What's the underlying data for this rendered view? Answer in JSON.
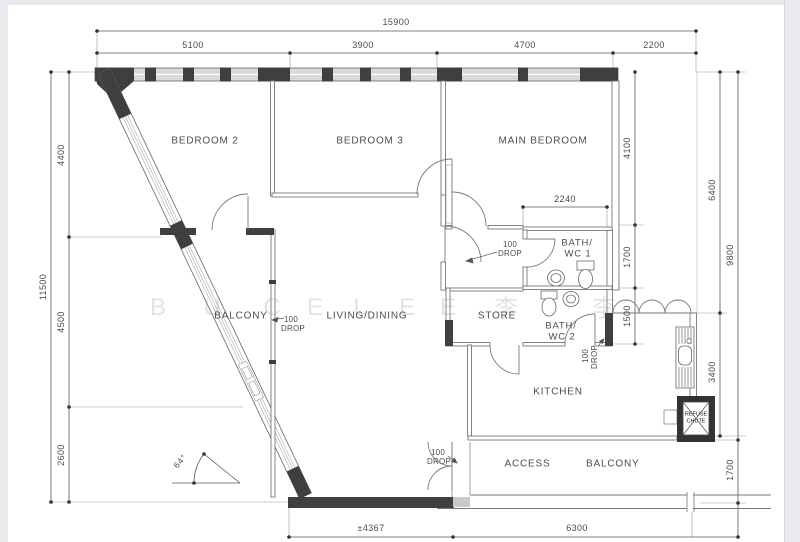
{
  "rooms": {
    "bedroom2": "BEDROOM 2",
    "bedroom3": "BEDROOM 3",
    "main_bedroom": "MAIN BEDROOM",
    "balcony": "BALCONY",
    "living_dining": "LIVING/DINING",
    "store": "STORE",
    "bath1_line1": "BATH/",
    "bath1_line2": "WC 1",
    "bath2_line1": "BATH/",
    "bath2_line2": "WC 2",
    "kitchen": "KITCHEN",
    "access_balcony": "ACCESS BALCONY",
    "refuse_line1": "REFUSE",
    "refuse_line2": "CHUTE"
  },
  "dimensions": {
    "top_total": "15900",
    "top_seg1": "5100",
    "top_seg2": "3900",
    "top_seg3": "4700",
    "top_seg4": "2200",
    "left_total": "11500",
    "left_seg1": "4400",
    "left_seg2": "4500",
    "left_seg3": "2600",
    "right_seg1": "4100",
    "right_seg2": "1700",
    "right_seg3": "1500",
    "right_outer_6400": "6400",
    "right_outer_3400": "3400",
    "right_outer_9800": "9800",
    "right_outer_1700": "1700",
    "bath_width": "2240",
    "bottom_seg1": "±4367",
    "bottom_seg2": "6300",
    "angle": "64°"
  },
  "annotations": {
    "drop_line1": "100",
    "drop_line2": "DROP",
    "watermark": [
      "B",
      "U",
      "C",
      "E",
      "L",
      "E",
      "E",
      "李",
      "李"
    ]
  }
}
